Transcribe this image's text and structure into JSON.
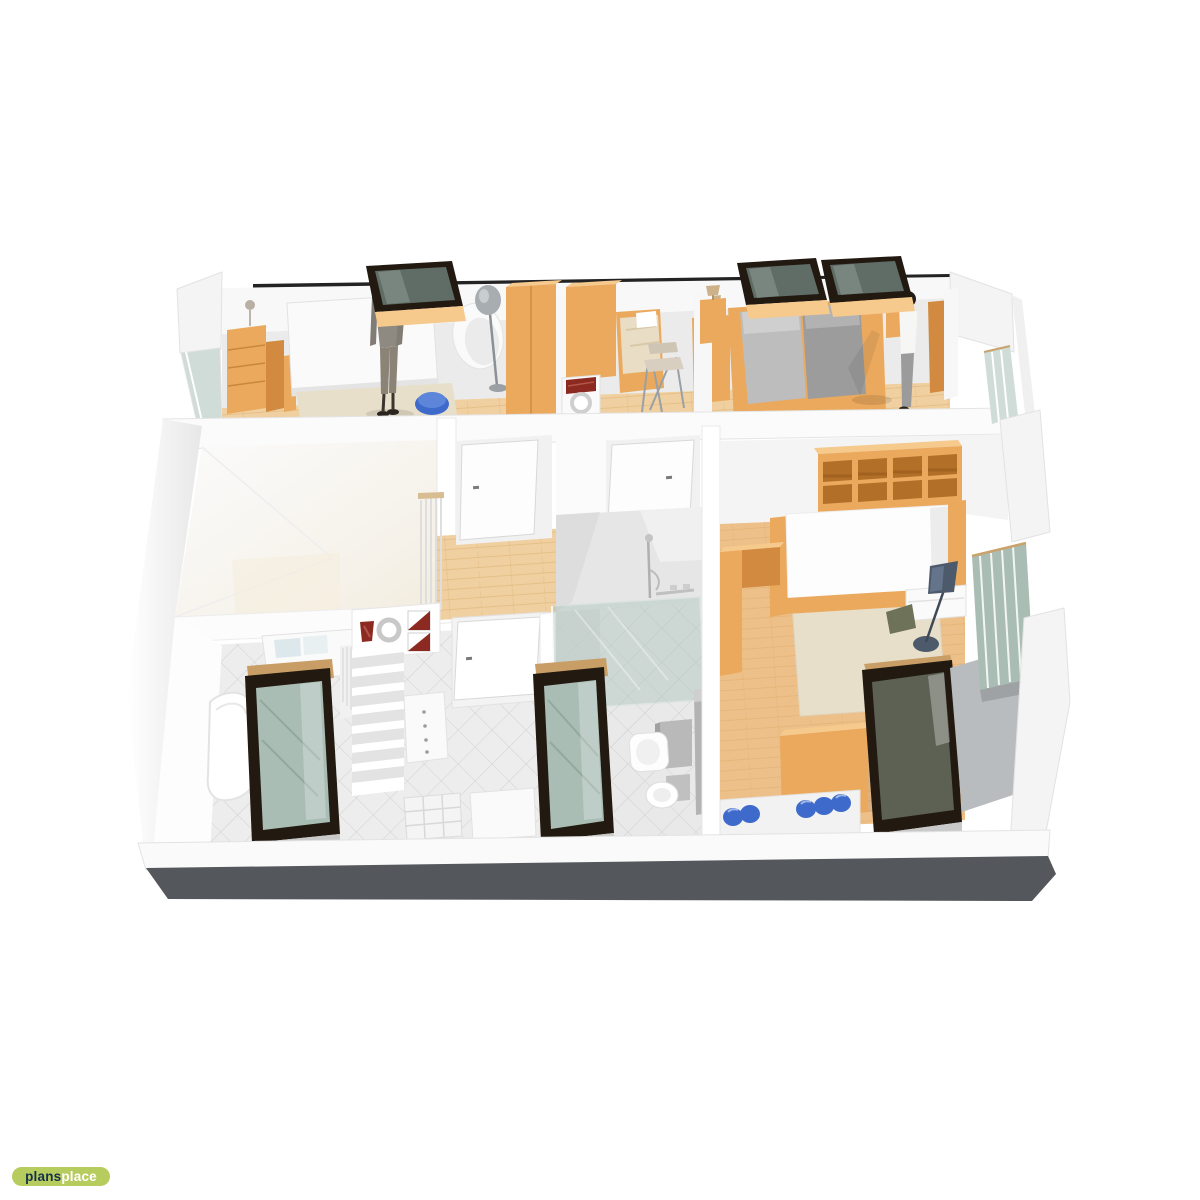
{
  "page": {
    "background": "#ffffff"
  },
  "logo": {
    "prefix": "plans",
    "suffix": "place"
  },
  "palette": {
    "shell": "#f4f4f4",
    "shell_bright": "#ffffff",
    "shell_shade": "#e3e3e3",
    "back_wall": "#ebebeb",
    "roofline": "#232323",
    "plinth": "#54575b",
    "wood": "#eba95e",
    "wood_dark": "#d18a3f",
    "wood_top": "#f6c98d",
    "floor_wood": "#f0d0a0",
    "floor_plank": "#d8a766",
    "floor_warm": "#eec089",
    "rug": "#e8dfca",
    "tile": "#ededed",
    "tile_line": "#c6c6c6",
    "glass": "#a9bdb4",
    "glass_light": "#cfdcd7",
    "frame_dark": "#221911",
    "frame_tan": "#c89e66",
    "mattress": "#9c9c9c",
    "mattress_light": "#bdbdbd",
    "white_furn": "#fafafa",
    "accent_blue": "#3e6bcb",
    "accent_red": "#8c2a22",
    "person": "#8f8a81",
    "slate": "#4d5a6b",
    "chair_red": "#7d3039",
    "skylight_glass": "#5f6d66",
    "logo_bg": "#b7cc5e",
    "logo_dark": "#16304a",
    "logo_light": "#ffffff"
  }
}
